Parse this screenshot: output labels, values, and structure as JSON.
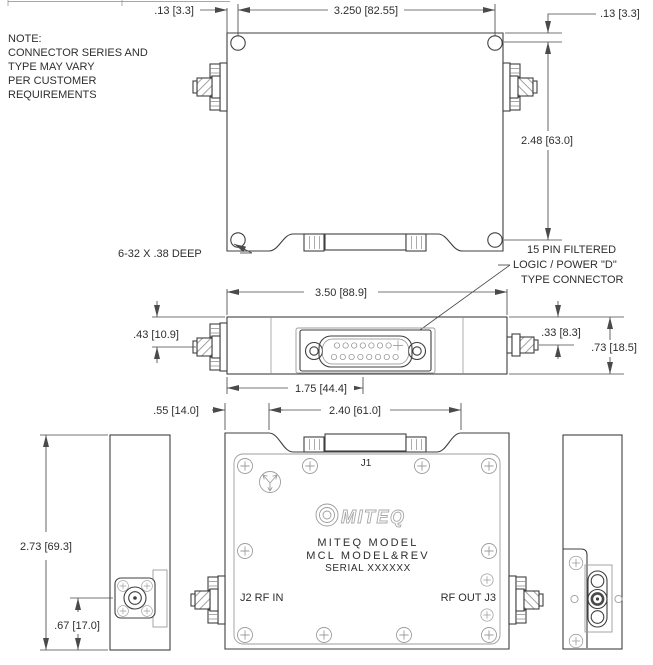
{
  "title": "MITEQ amplifier module outline drawing",
  "note": {
    "line1": "NOTE:",
    "line2": "CONNECTOR SERIES AND",
    "line3": "TYPE MAY VARY",
    "line4": "PER CUSTOMER",
    "line5": "REQUIREMENTS"
  },
  "callouts": {
    "tap": "6-32 X .38 DEEP",
    "dsub_line1": "15 PIN FILTERED",
    "dsub_line2": "LOGIC / POWER \"D\"",
    "dsub_line3": "TYPE CONNECTOR"
  },
  "dimensions": {
    "hole_offset_left": ".13 [3.3]",
    "hole_span_width": "3.250 [82.55]",
    "hole_offset_right": ".13 [3.3]",
    "hole_span_height": "2.48 [63.0]",
    "body_width": "3.50 [88.9]",
    "sma_left_drop": ".43 [10.9]",
    "sma_right_drop": ".33 [8.3]",
    "body_thickness": ".73 [18.5]",
    "dsub_center": "1.75 [44.4]",
    "notch_offset": ".55 [14.0]",
    "notch_width": "2.40 [61.0]",
    "body_height": "2.73 [69.3]",
    "rf_center_height": ".67 [17.0]"
  },
  "faceplate": {
    "j1": "J1",
    "brand": "MITEQ",
    "model_line1": "MITEQ MODEL",
    "model_line2": "MCL MODEL&REV",
    "serial": "SERIAL XXXXXX",
    "j2": "J2 RF IN",
    "j3": "RF OUT J3"
  },
  "colors": {
    "line": "#3f3f3f",
    "dim": "#4a4a4a",
    "light": "#9c9c9c"
  }
}
